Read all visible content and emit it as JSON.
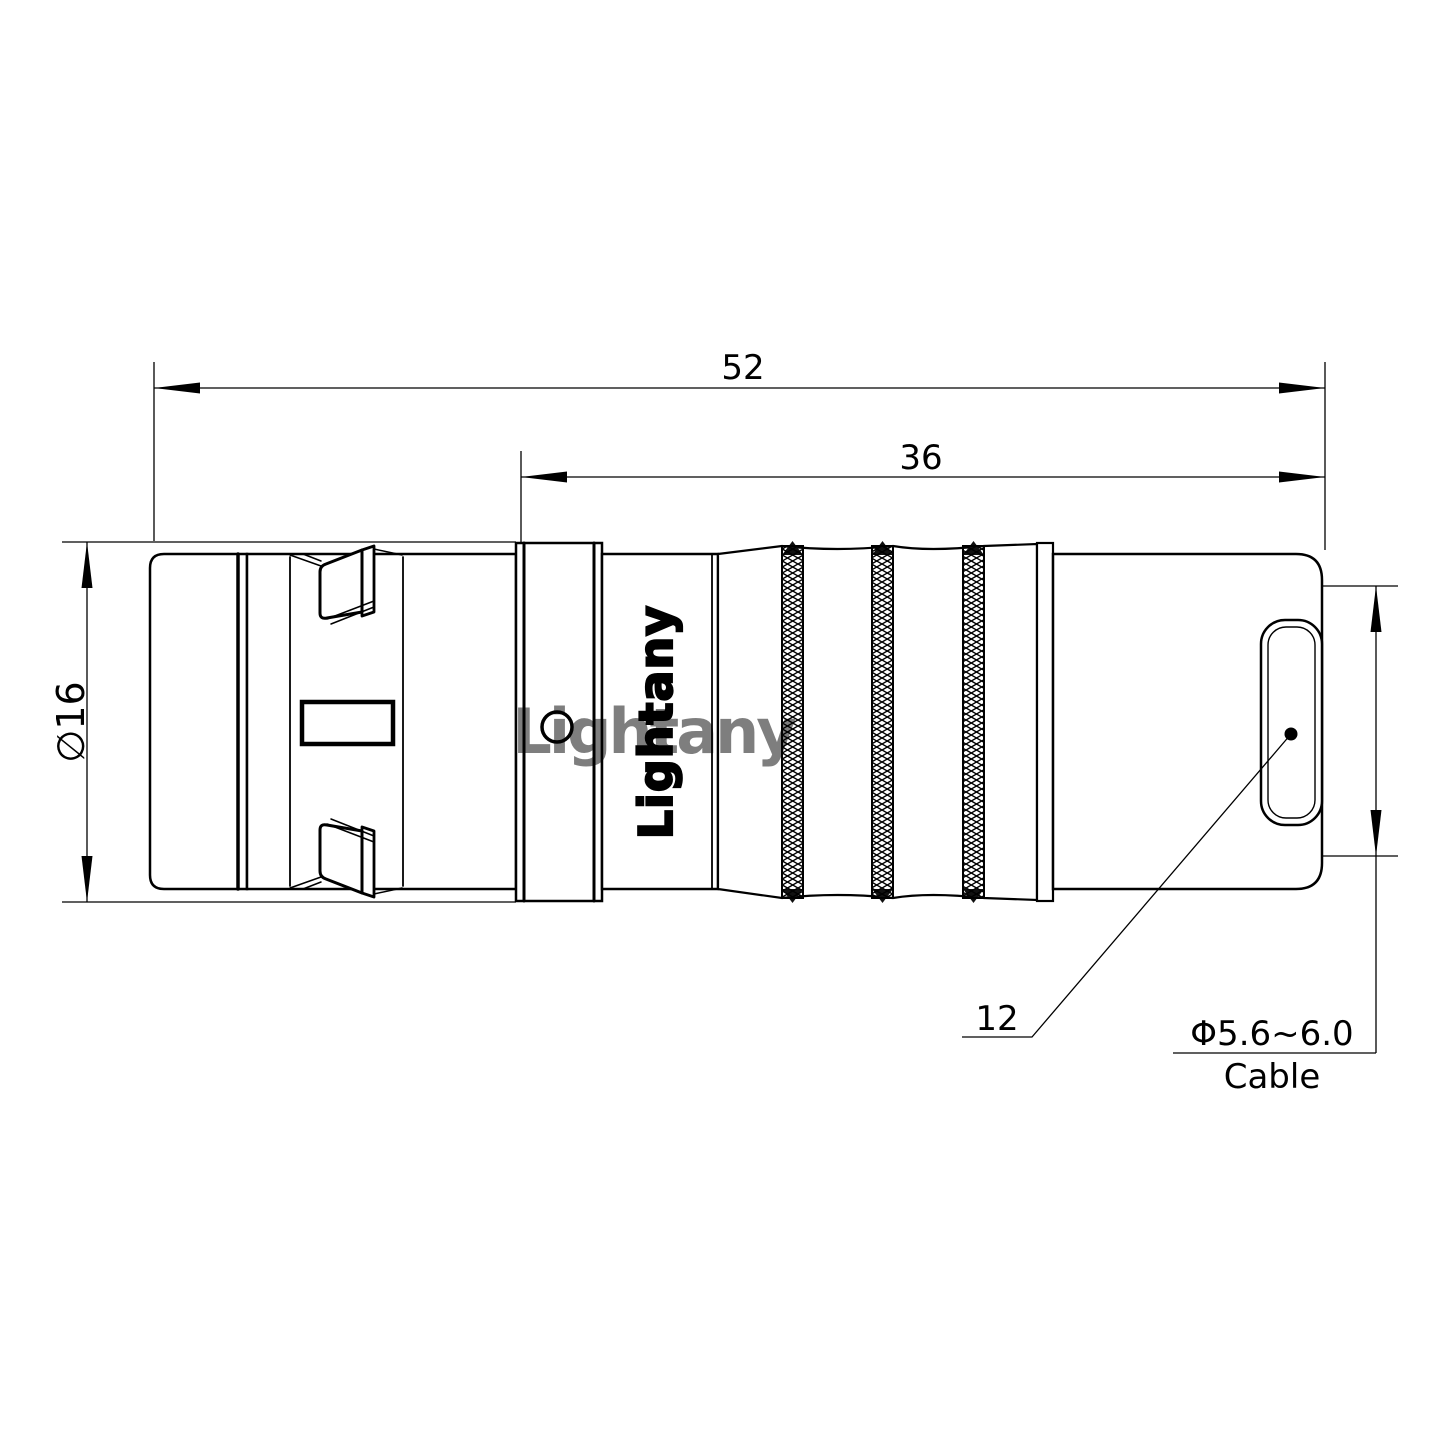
{
  "drawing": {
    "line_color": "#000000",
    "background": "#ffffff",
    "watermark_text": "Lightany",
    "watermark_color": "#cb7070",
    "logo_text": "Lightany",
    "dims": {
      "overall_length": "52",
      "mid_length": "36",
      "outer_diameter": "∅16",
      "rear_label": "12",
      "cable_diameter": "Φ5.6~6.0",
      "cable_word": "Cable"
    }
  }
}
